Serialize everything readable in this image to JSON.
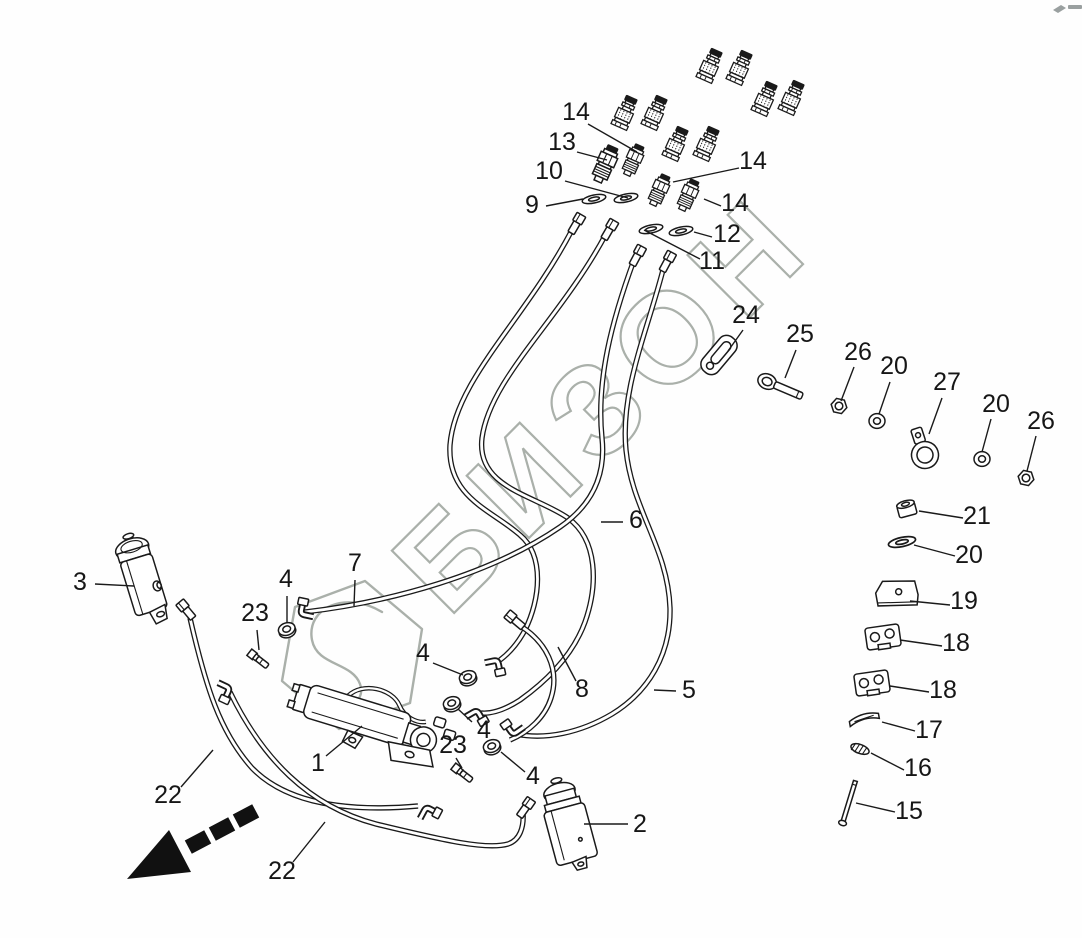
{
  "watermark": {
    "text": "БИЗОН",
    "color": "#aab0aa"
  },
  "colors": {
    "ink": "#1a1a1a",
    "background": "#fefefe",
    "watermark": "#aab0aa",
    "arrow": "#111111"
  },
  "icons": {
    "direction_arrow": "dashed-arrow-down-left",
    "watermark_logo": "hexagon-s-logo"
  },
  "callouts": [
    {
      "label": "14"
    },
    {
      "label": "13"
    },
    {
      "label": "10"
    },
    {
      "label": "9"
    },
    {
      "label": "14"
    },
    {
      "label": "14"
    },
    {
      "label": "12"
    },
    {
      "label": "11"
    },
    {
      "label": "24"
    },
    {
      "label": "25"
    },
    {
      "label": "26"
    },
    {
      "label": "20"
    },
    {
      "label": "27"
    },
    {
      "label": "20"
    },
    {
      "label": "26"
    },
    {
      "label": "21"
    },
    {
      "label": "20"
    },
    {
      "label": "19"
    },
    {
      "label": "18"
    },
    {
      "label": "18"
    },
    {
      "label": "17"
    },
    {
      "label": "16"
    },
    {
      "label": "15"
    },
    {
      "label": "6"
    },
    {
      "label": "5"
    },
    {
      "label": "8"
    },
    {
      "label": "7"
    },
    {
      "label": "3"
    },
    {
      "label": "4"
    },
    {
      "label": "23"
    },
    {
      "label": "4"
    },
    {
      "label": "4"
    },
    {
      "label": "23"
    },
    {
      "label": "4"
    },
    {
      "label": "1"
    },
    {
      "label": "2"
    },
    {
      "label": "22"
    },
    {
      "label": "22"
    }
  ]
}
